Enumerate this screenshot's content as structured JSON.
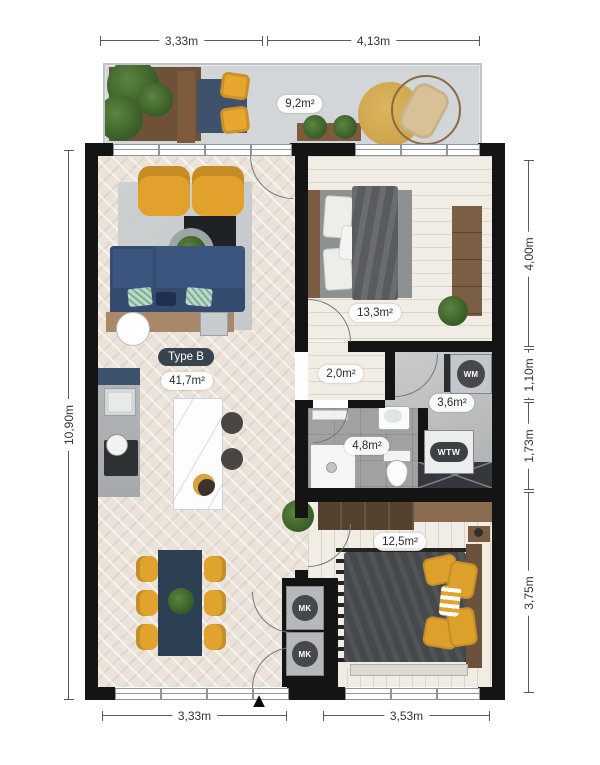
{
  "plan": {
    "type_label": "Type B",
    "entrance_marker": "▲"
  },
  "dimensions": {
    "top": [
      "3,33m",
      "4,13m"
    ],
    "left": [
      "10,90m"
    ],
    "right": [
      "4,00m",
      "1,10m",
      "1,73m",
      "3,75m"
    ],
    "bottom": [
      "3,33m",
      "3,53m"
    ]
  },
  "rooms": {
    "balcony": {
      "area": "9,2m²"
    },
    "living": {
      "area": "41,7m²"
    },
    "bedroom_1": {
      "area": "13,3m²"
    },
    "hallway": {
      "area": "2,0m²"
    },
    "installation": {
      "area": "3,6m²",
      "wm_label": "WM",
      "wtw_label": "WTW"
    },
    "bathroom": {
      "area": "4,8m²"
    },
    "bedroom_2": {
      "area": "12,5m²",
      "mk_label_1": "MK",
      "mk_label_2": "MK"
    }
  },
  "colors": {
    "wall": "#141414",
    "accent_yellow": "#e2a02c",
    "accent_blue": "#3c557e",
    "wood": "#7c5c41",
    "living_floor": "#ebe3d9",
    "tile_floor": "#9fa1a3",
    "balcony_floor": "#d3d6d8"
  }
}
